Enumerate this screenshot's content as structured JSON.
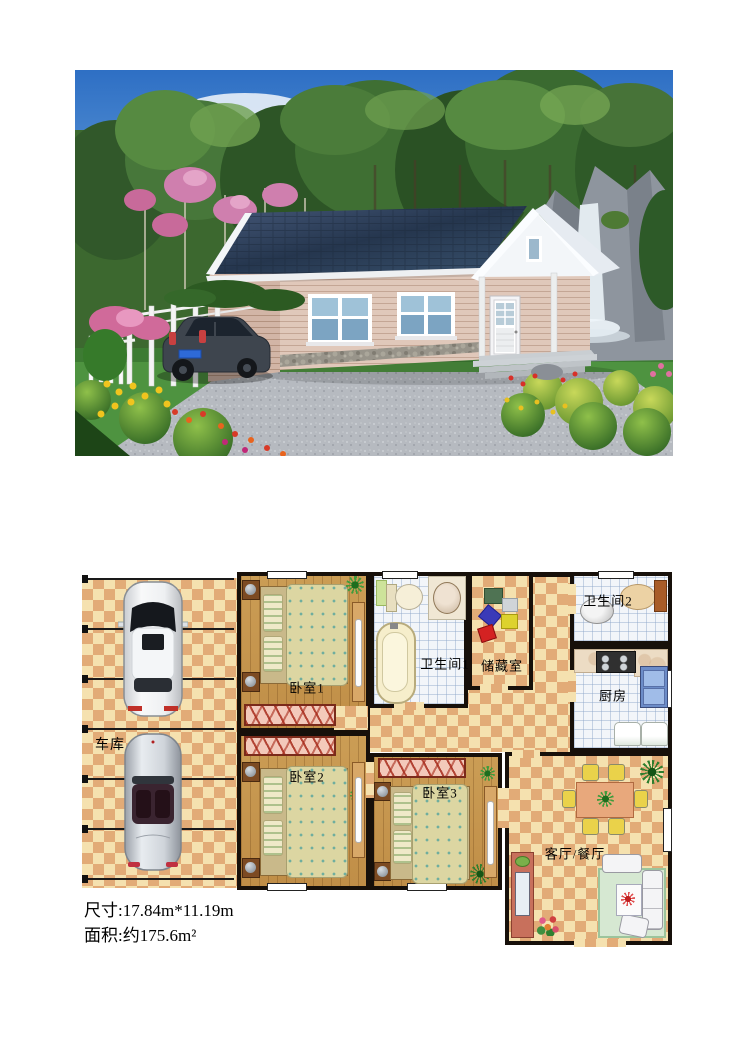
{
  "photo": {
    "colors": {
      "sky": "#2e6fc4",
      "roof": "#273850",
      "wall_siding": "#e0c8ba",
      "white_trim": "#f3f6f9",
      "driveway_gravel": "#b6bac0",
      "lawn": "#4e9340"
    }
  },
  "floor_plan": {
    "rooms": [
      {
        "id": "garage",
        "label": "车库"
      },
      {
        "id": "bedroom-1",
        "label": "卧室1"
      },
      {
        "id": "bedroom-2",
        "label": "卧室2"
      },
      {
        "id": "bedroom-3",
        "label": "卧室3"
      },
      {
        "id": "bathroom-1",
        "label": "卫生间1"
      },
      {
        "id": "bathroom-2",
        "label": "卫生间2"
      },
      {
        "id": "storage",
        "label": "储藏室"
      },
      {
        "id": "kitchen",
        "label": "厨房"
      },
      {
        "id": "living-dining",
        "label": "客厅/餐厅"
      }
    ]
  },
  "specs": {
    "dimensions": "尺寸:17.84m*11.19m",
    "area": "面积:约175.6m²"
  }
}
